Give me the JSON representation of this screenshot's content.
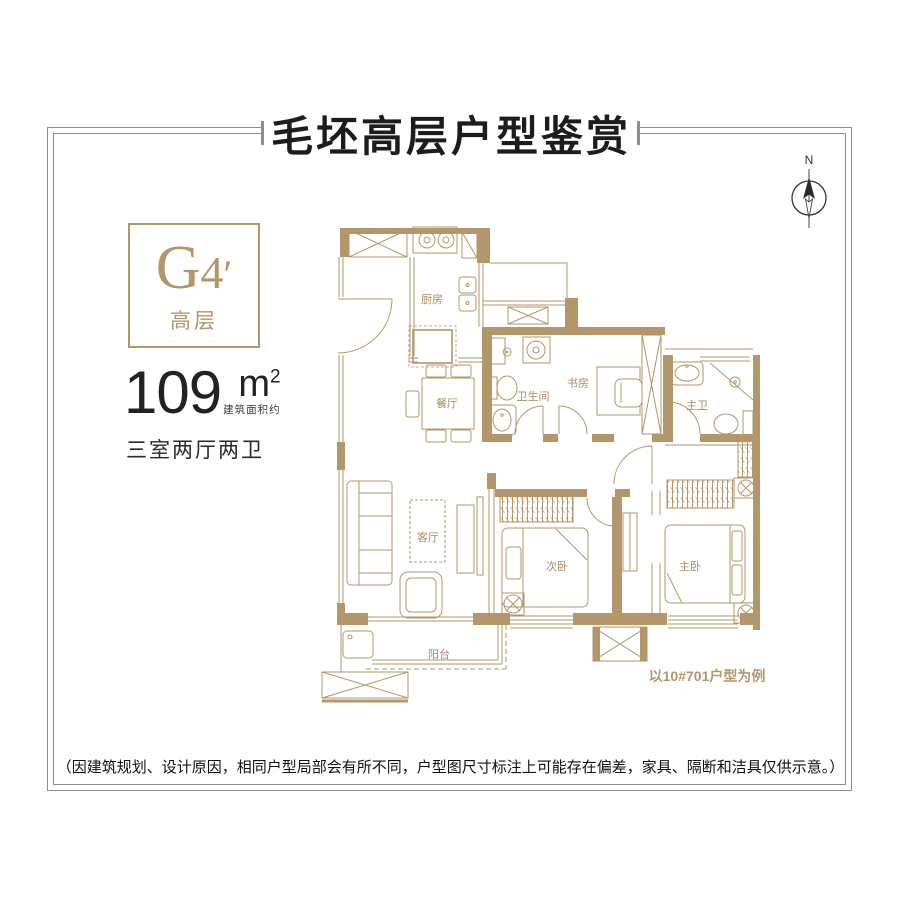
{
  "title": "毛坯高层户型鉴赏",
  "compass_label": "N",
  "unit_card": {
    "code_main": "G",
    "code_sub": "4",
    "code_prime": "′",
    "tier": "高层"
  },
  "area": {
    "value": "109",
    "unit": "m",
    "sup": "2",
    "note": "建筑面积约",
    "layout": "三室两厅两卫"
  },
  "rooms": {
    "kitchen": "厨房",
    "dining": "餐厅",
    "bathroom": "卫生间",
    "study": "书房",
    "master_bathroom": "主卫",
    "living_room": "客厅",
    "second_bedroom": "次卧",
    "master_bedroom": "主卧",
    "balcony": "阳台"
  },
  "caption": "以10#701户型为例",
  "disclaimer": "（因建筑规划、设计原因，相同户型局部会有所不同，户型图尺寸标注上可能存在偏差，家具、隔断和洁具仅供示意。）",
  "colors": {
    "wall": "#b3966a",
    "gold": "#a98c5f",
    "frame": "#8e8e8e",
    "ink": "#1c1c1c"
  }
}
